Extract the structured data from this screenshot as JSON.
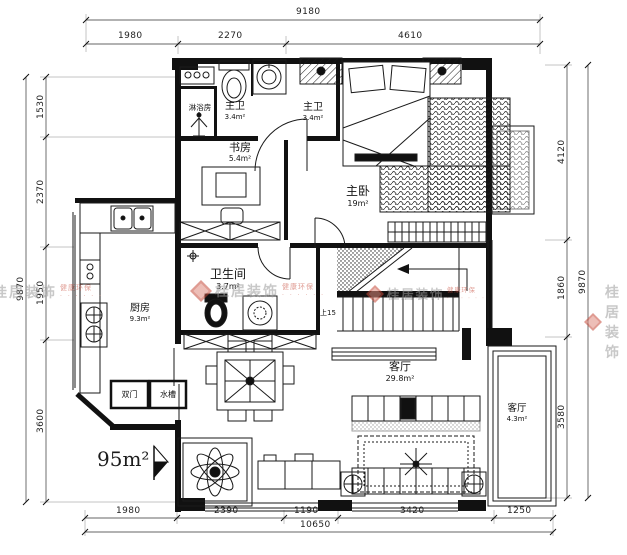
{
  "dims": {
    "top": {
      "overall": "9180",
      "seg0": "1980",
      "seg1": "2270",
      "seg2": "4610"
    },
    "bottom": {
      "overall": "10650",
      "seg0": "1980",
      "seg1": "2390",
      "seg2": "1190",
      "seg3": "3420",
      "seg4": "1250"
    },
    "left": {
      "overall": "9870",
      "seg0": "1530",
      "seg1": "2370",
      "seg2": "1950",
      "seg3": "3600"
    },
    "right": {
      "overall": "9870",
      "seg0": "4120",
      "seg1": "1860",
      "seg2": "3580"
    }
  },
  "rooms": {
    "shower": {
      "name": "淋浴房",
      "area": ""
    },
    "master_bath": {
      "name": "主卫",
      "area": "3.4m²"
    },
    "hall_bath": {
      "name": "主卫",
      "area": "3.4m²"
    },
    "study": {
      "name": "书房",
      "area": "5.4m²"
    },
    "master_bedroom": {
      "name": "主卧",
      "area": "19m²"
    },
    "bathroom": {
      "name": "卫生间",
      "area": "3.7m²"
    },
    "kitchen": {
      "name": "厨房",
      "area": "9.3m²"
    },
    "living": {
      "name": "客厅",
      "area": "29.8m²"
    },
    "balcony": {
      "name": "客厅",
      "area": "4.3m²"
    }
  },
  "annotations": {
    "total_area": "95m²",
    "stairs_up": "上15",
    "box_left": "双门",
    "box_right": "水槽"
  },
  "watermark": {
    "brand": "桂居装饰",
    "tagline": "健康环保",
    "dots": "· · · · · ·"
  },
  "colors": {
    "line": "#1a1a1a",
    "watermark_gray": "#9c9c9c",
    "watermark_red": "#c64a3a",
    "background": "#ffffff"
  }
}
